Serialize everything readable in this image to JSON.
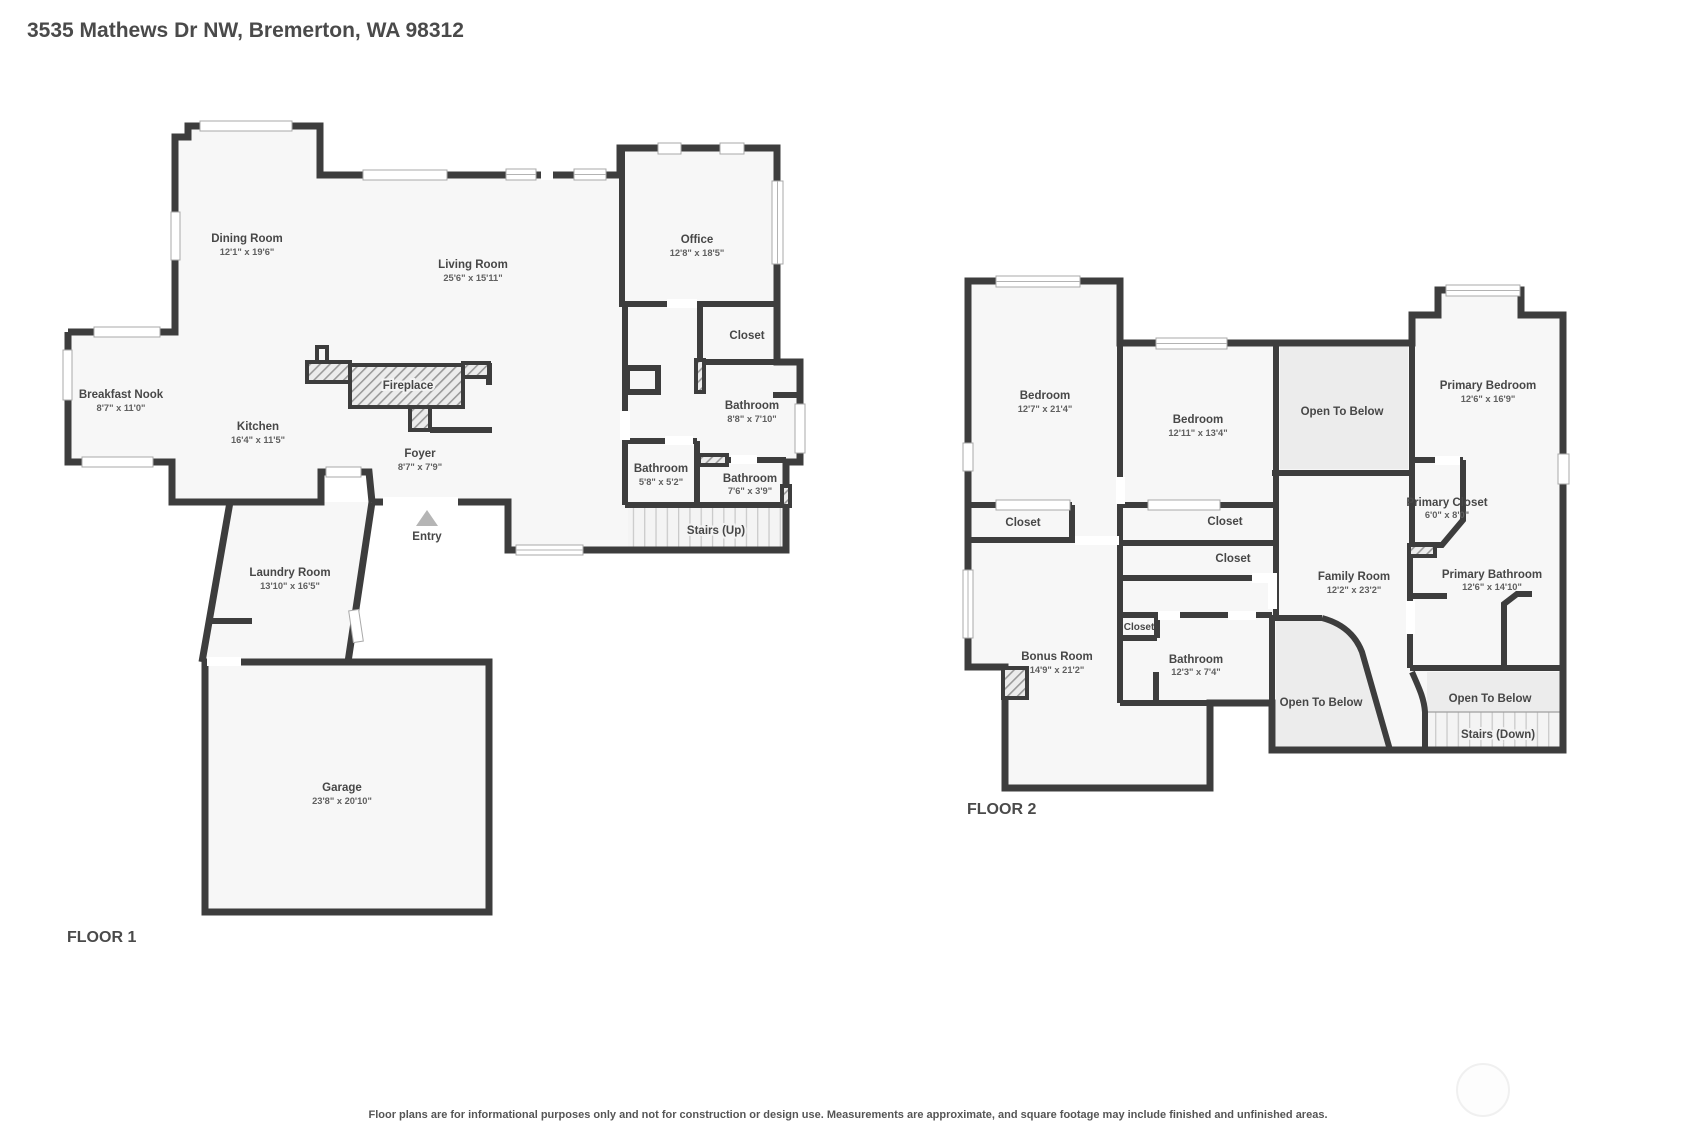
{
  "title": "3535 Mathews Dr NW, Bremerton, WA 98312",
  "disclaimer": "Floor plans are for informational purposes only and not for construction or design use. Measurements are approximate, and square footage may include finished and unfinished areas.",
  "colors": {
    "wall": "#3d3d3d",
    "floor_fill": "#f7f7f7",
    "open_to_below_fill": "#ececec",
    "label_text": "#474747"
  },
  "floor1": {
    "label": "FLOOR 1",
    "rooms": {
      "dining": {
        "name": "Dining Room",
        "dims": "12'1\" x 19'6\""
      },
      "living": {
        "name": "Living Room",
        "dims": "25'6\" x 15'11\""
      },
      "office": {
        "name": "Office",
        "dims": "12'8\" x 18'5\""
      },
      "closet": {
        "name": "Closet"
      },
      "breakfast": {
        "name": "Breakfast Nook",
        "dims": "8'7\" x 11'0\""
      },
      "kitchen": {
        "name": "Kitchen",
        "dims": "16'4\" x 11'5\""
      },
      "fireplace": {
        "name": "Fireplace"
      },
      "foyer": {
        "name": "Foyer",
        "dims": "8'7\" x 7'9\""
      },
      "bath_main": {
        "name": "Bathroom",
        "dims": "8'8\" x 7'10\""
      },
      "bath_small": {
        "name": "Bathroom",
        "dims": "5'8\" x 5'2\""
      },
      "bath_tiny": {
        "name": "Bathroom",
        "dims": "7'6\" x 3'9\""
      },
      "stairs": {
        "name": "Stairs (Up)"
      },
      "entry": {
        "name": "Entry"
      },
      "laundry": {
        "name": "Laundry Room",
        "dims": "13'10\" x 16'5\""
      },
      "garage": {
        "name": "Garage",
        "dims": "23'8\" x 20'10\""
      }
    }
  },
  "floor2": {
    "label": "FLOOR 2",
    "rooms": {
      "bedroom1": {
        "name": "Bedroom",
        "dims": "12'7\" x 21'4\""
      },
      "bedroom2": {
        "name": "Bedroom",
        "dims": "12'11\" x 13'4\""
      },
      "primary_bedroom": {
        "name": "Primary Bedroom",
        "dims": "12'6\" x 16'9\""
      },
      "otb_top": {
        "name": "Open To Below"
      },
      "closet_bed1": {
        "name": "Closet"
      },
      "closet_bed2a": {
        "name": "Closet"
      },
      "closet_bed2b": {
        "name": "Closet"
      },
      "primary_closet": {
        "name": "Primary Closet",
        "dims": "6'0\" x 8'0\""
      },
      "family": {
        "name": "Family Room",
        "dims": "12'2\" x 23'2\""
      },
      "primary_bath": {
        "name": "Primary Bathroom",
        "dims": "12'6\" x 14'10\""
      },
      "closet_hall": {
        "name": "Closet"
      },
      "bonus": {
        "name": "Bonus Room",
        "dims": "14'9\" x 21'2\""
      },
      "bath": {
        "name": "Bathroom",
        "dims": "12'3\" x 7'4\""
      },
      "otb_left": {
        "name": "Open To Below"
      },
      "otb_right": {
        "name": "Open To Below"
      },
      "stairs": {
        "name": "Stairs (Down)"
      }
    }
  }
}
